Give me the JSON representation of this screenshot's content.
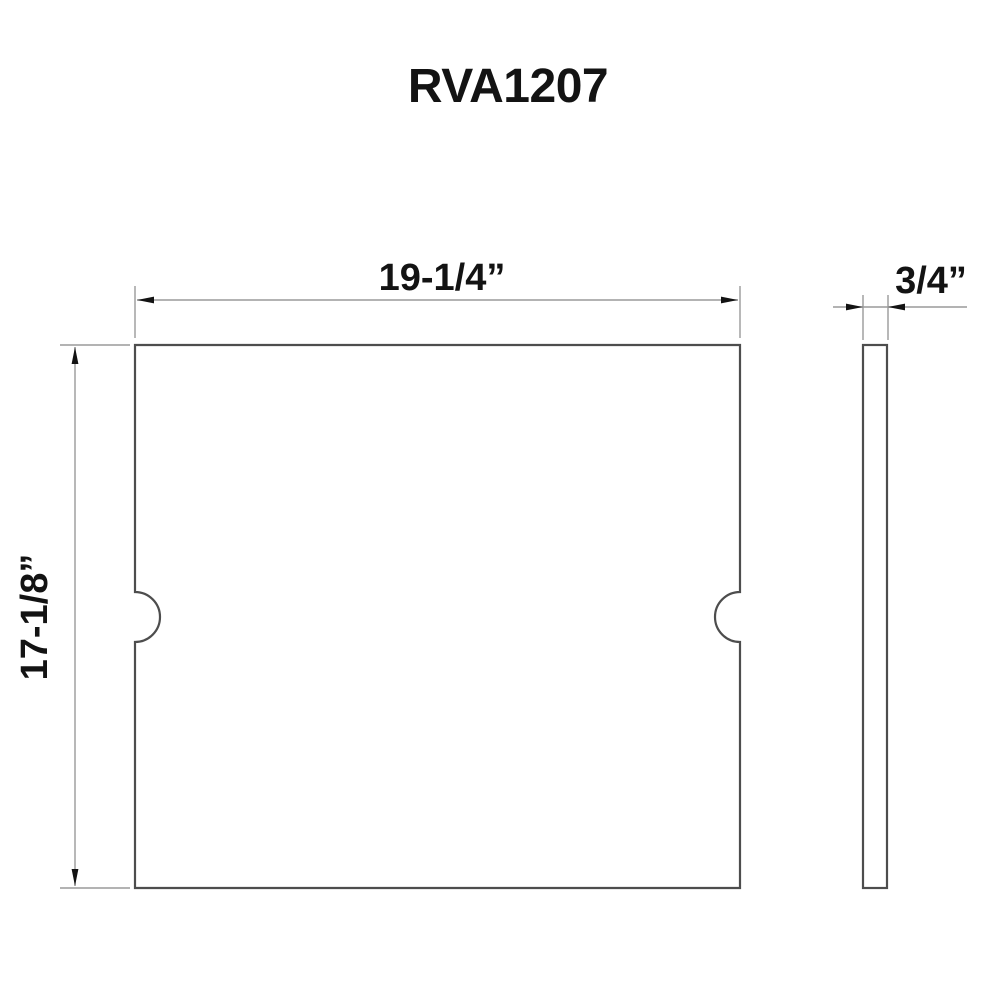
{
  "title": "RVA1207",
  "dimensions": {
    "width": "19-1/4”",
    "height": "17-1/8”",
    "thickness": "3/4”"
  },
  "colors": {
    "background": "#ffffff",
    "outline": "#4d4d4d",
    "dimline": "#9a9a9a",
    "ink": "#131313"
  }
}
